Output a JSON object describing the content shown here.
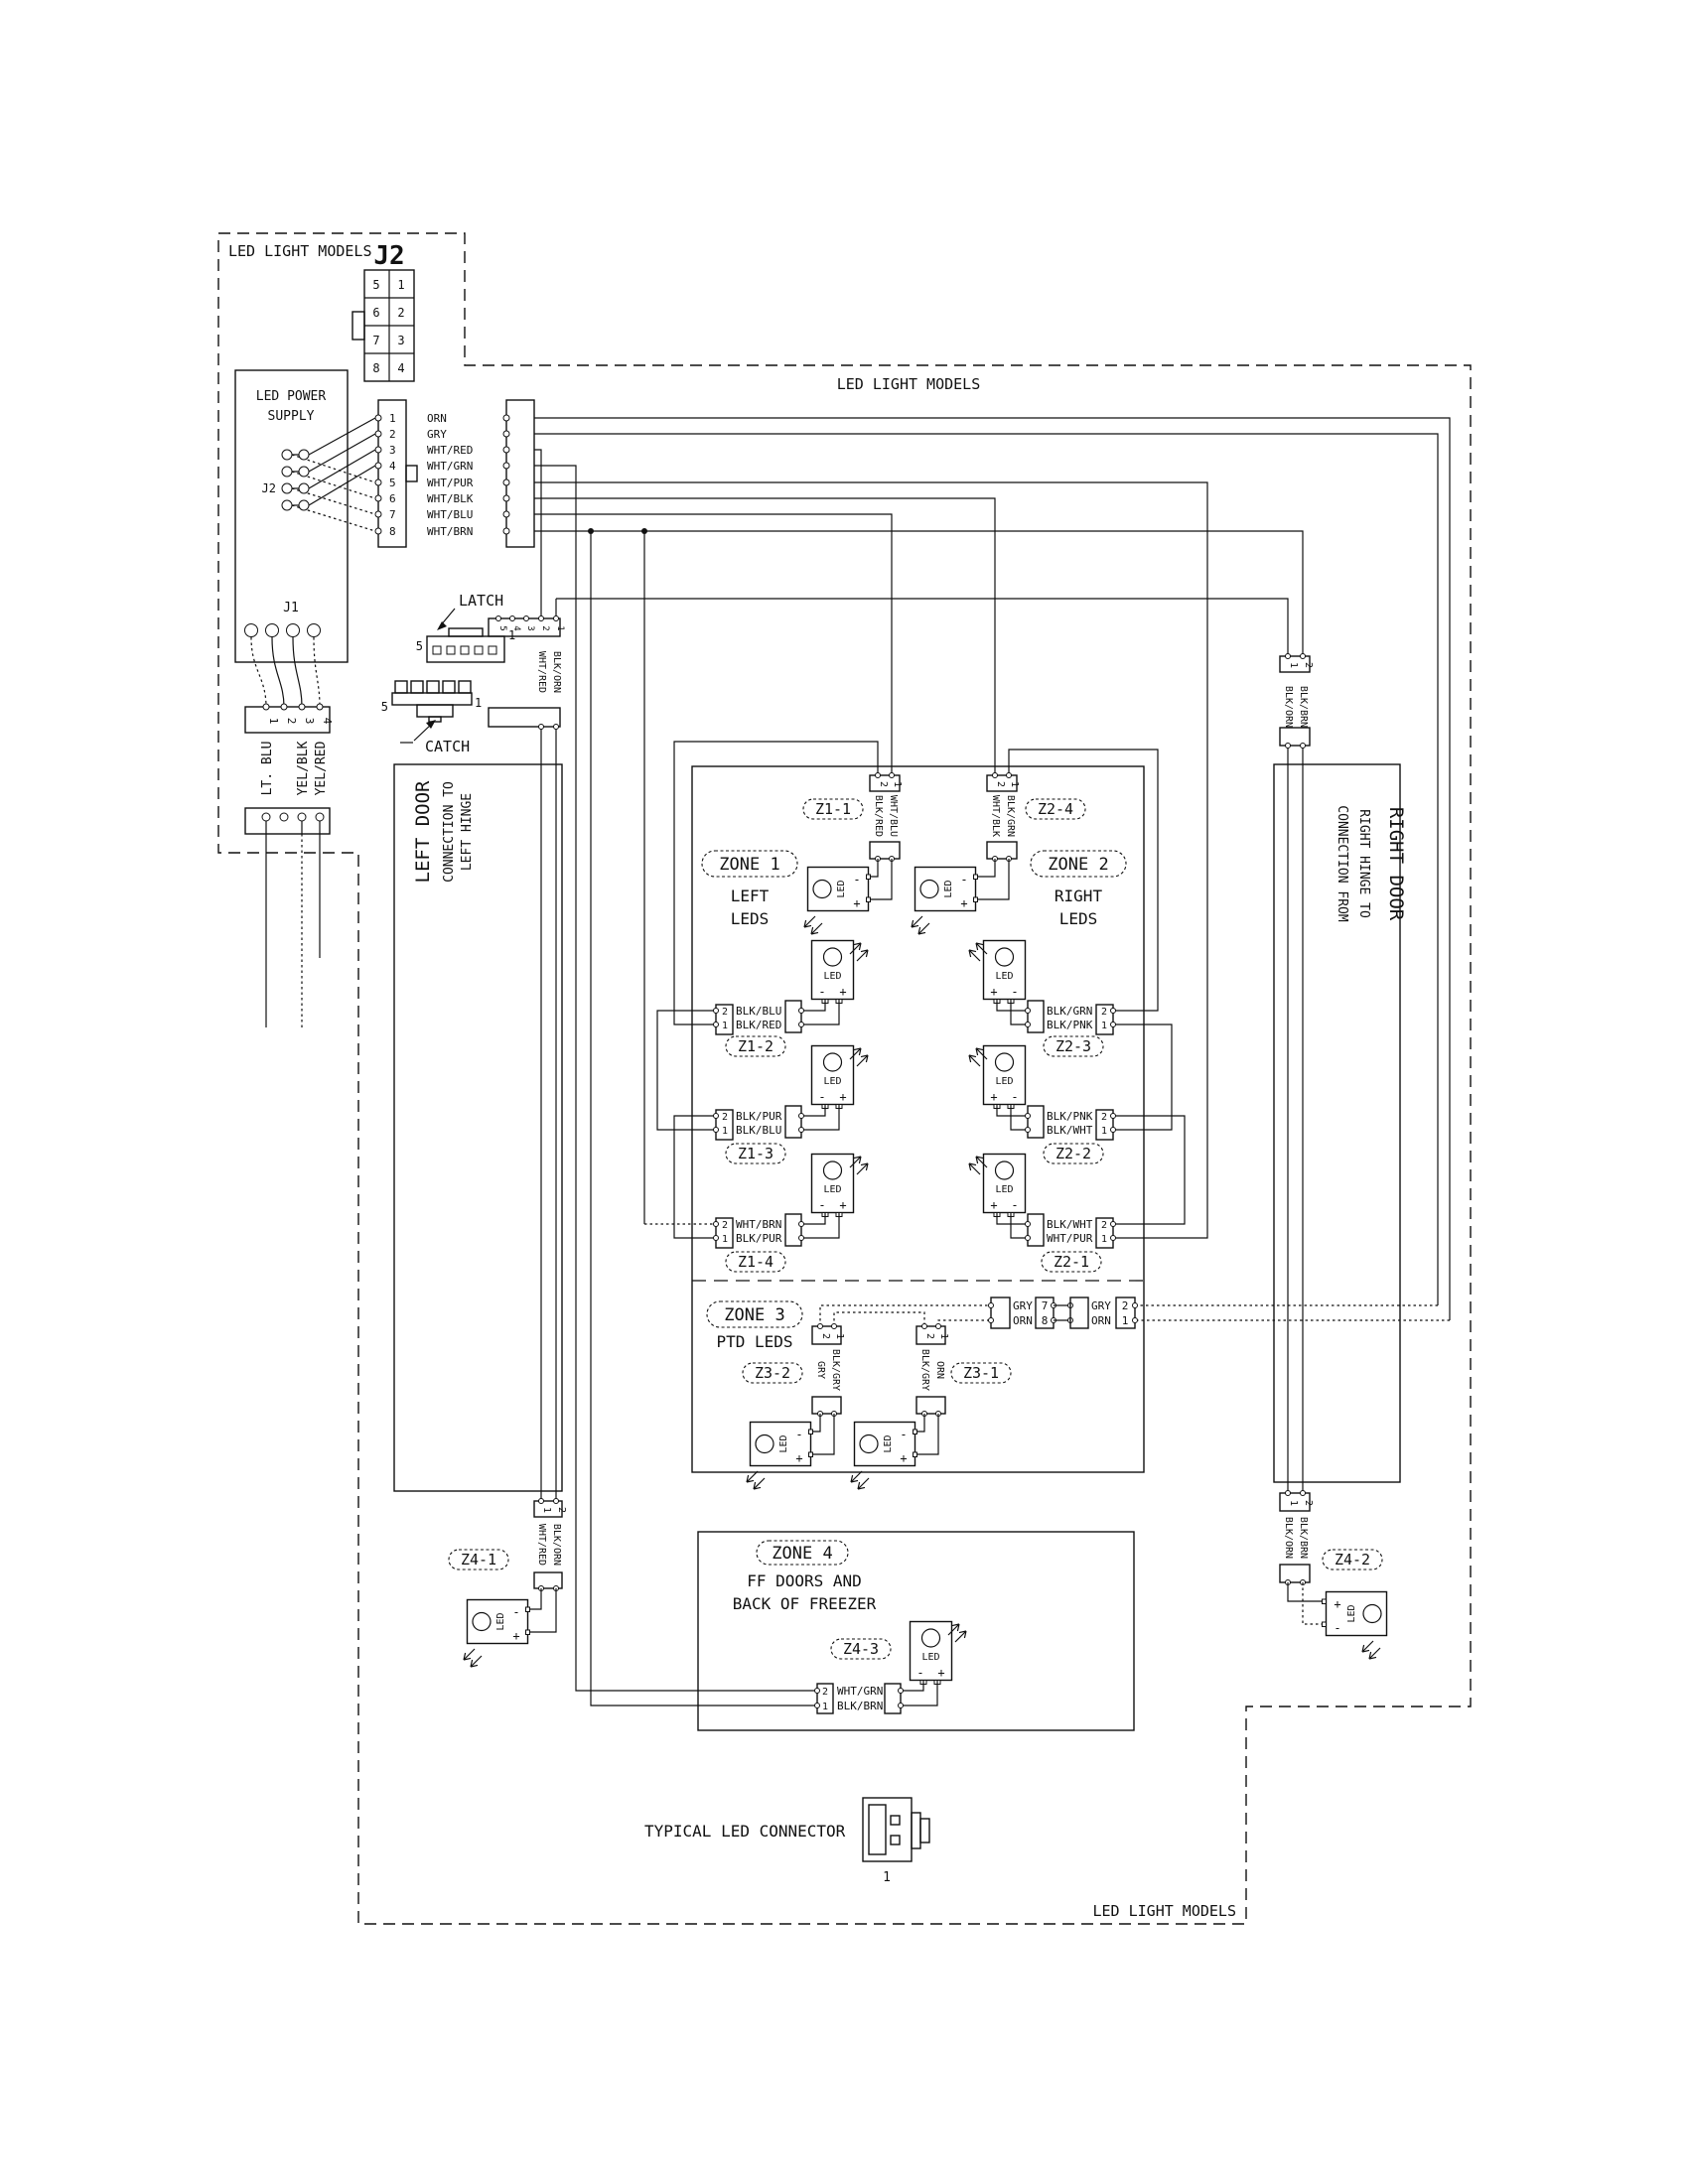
{
  "header": {
    "top_left": "LED LIGHT MODELS",
    "top_center": "LED LIGHT MODELS",
    "bottom_right": "LED LIGHT MODELS"
  },
  "j2": {
    "label": "J2",
    "cells": [
      "5",
      "1",
      "6",
      "2",
      "7",
      "3",
      "8",
      "4"
    ]
  },
  "ps": {
    "l1": "LED POWER",
    "l2": "SUPPLY",
    "j2": "J2",
    "j1": "J1"
  },
  "bus": {
    "p": [
      "1",
      "2",
      "3",
      "4",
      "5",
      "6",
      "7",
      "8"
    ],
    "w": [
      "ORN",
      "GRY",
      "WHT/RED",
      "WHT/GRN",
      "WHT/PUR",
      "WHT/BLK",
      "WHT/BLU",
      "WHT/BRN"
    ]
  },
  "j1c": {
    "p": [
      "1",
      "2",
      "3",
      "4"
    ],
    "w1": "LT. BLU",
    "w3": "YEL/BLK",
    "w4": "YEL/RED"
  },
  "latch": {
    "label": "LATCH",
    "five": "5",
    "one": "1",
    "pins": [
      "5",
      "4",
      "3",
      "2",
      "1"
    ],
    "w1": "WHT/RED",
    "w2": "BLK/ORN"
  },
  "catch": {
    "label": "CATCH",
    "five": "5",
    "one": "1"
  },
  "ldoor": {
    "l1": "LEFT DOOR",
    "l2": "CONNECTION TO",
    "l3": "LEFT HINGE"
  },
  "rdoor": {
    "l1": "CONNECTION FROM",
    "l2": "RIGHT HINGE TO",
    "l3": "RIGHT DOOR"
  },
  "z1": {
    "title": "ZONE 1",
    "s1": "LEFT",
    "s2": "LEDS",
    "c1": {
      "tag": "Z1-1",
      "p2": "2",
      "p1": "1",
      "w2": "BLK/RED",
      "w1": "WHT/BLU"
    },
    "c2": {
      "tag": "Z1-2",
      "p2": "2",
      "p1": "1",
      "w2": "BLK/BLU",
      "w1": "BLK/RED"
    },
    "c3": {
      "tag": "Z1-3",
      "p2": "2",
      "p1": "1",
      "w2": "BLK/PUR",
      "w1": "BLK/BLU"
    },
    "c4": {
      "tag": "Z1-4",
      "p2": "2",
      "p1": "1",
      "w2": "WHT/BRN",
      "w1": "BLK/PUR"
    }
  },
  "z2": {
    "title": "ZONE 2",
    "s1": "RIGHT",
    "s2": "LEDS",
    "c4": {
      "tag": "Z2-4",
      "p2": "2",
      "p1": "1",
      "w2": "WHT/BLK",
      "w1": "BLK/GRN"
    },
    "c3": {
      "tag": "Z2-3",
      "p2": "2",
      "p1": "1",
      "w2": "BLK/GRN",
      "w1": "BLK/PNK"
    },
    "c2": {
      "tag": "Z2-2",
      "p2": "2",
      "p1": "1",
      "w2": "BLK/PNK",
      "w1": "BLK/WHT"
    },
    "c1": {
      "tag": "Z2-1",
      "p2": "2",
      "p1": "1",
      "w2": "BLK/WHT",
      "w1": "WHT/PUR"
    }
  },
  "z3": {
    "title": "ZONE 3",
    "sub": "PTD LEDS",
    "c2": {
      "tag": "Z3-2",
      "p2": "2",
      "p1": "1",
      "wL": "GRY",
      "wR": "BLK/GRY"
    },
    "c1": {
      "tag": "Z3-1",
      "p2": "2",
      "p1": "1",
      "wL": "BLK/GRY",
      "wR": "ORN"
    },
    "chain": {
      "gry": "GRY",
      "orn": "ORN",
      "p7": "7",
      "p8": "8",
      "p2": "2",
      "p1": "1"
    }
  },
  "z4": {
    "title": "ZONE 4",
    "s1": "FF DOORS AND",
    "s2": "BACK OF FREEZER",
    "c3": {
      "tag": "Z4-3",
      "p2": "2",
      "p1": "1",
      "w2": "WHT/GRN",
      "w1": "BLK/BRN"
    },
    "c1": {
      "tag": "Z4-1",
      "p1": "1",
      "p2": "2",
      "w1": "WHT/RED",
      "w2": "BLK/ORN"
    },
    "c2": {
      "tag": "Z4-2",
      "p1": "1",
      "p2": "2",
      "w1": "BLK/ORN",
      "w2": "BLK/BRN"
    }
  },
  "rconn": {
    "p1": "1",
    "p2": "2",
    "w1": "BLK/ORN",
    "w2": "BLK/BRN"
  },
  "led": {
    "label": "LED",
    "minus": "-",
    "plus": "+"
  },
  "typical": {
    "label": "TYPICAL LED CONNECTOR",
    "pin": "1"
  }
}
